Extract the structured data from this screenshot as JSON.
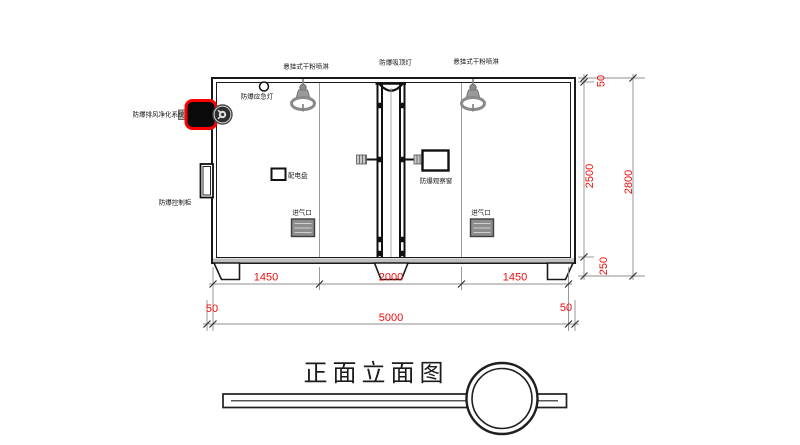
{
  "title": {
    "text": "正面立面图"
  },
  "component_labels": {
    "sprinkler_left": "悬挂式干粉喷淋",
    "ceiling_light": "防爆吸顶灯",
    "sprinkler_right": "悬挂式干粉喷淋",
    "emergency_light": "防爆应急灯",
    "exhaust_purification_system": "防爆排风净化系统",
    "control_cabinet": "防爆控制柜",
    "distribution_panel": "配电盘",
    "observation_window": "防爆观察窗",
    "air_inlet_left": "进气口",
    "air_inlet_right": "进气口"
  },
  "dimensions": {
    "bottom_row": [
      "1450",
      "2000",
      "1450"
    ],
    "left_offset": "50",
    "total_width": "5000",
    "right_offset": "50",
    "height_top_offset": "50",
    "height_main": "2500",
    "height_base": "250",
    "height_total": "2800"
  },
  "colors": {
    "dimension_text": "#f20d0d",
    "highlight_outline": "#ff0000",
    "line": "#1a1a1a",
    "fixture_gray": "#8a8a8a"
  }
}
